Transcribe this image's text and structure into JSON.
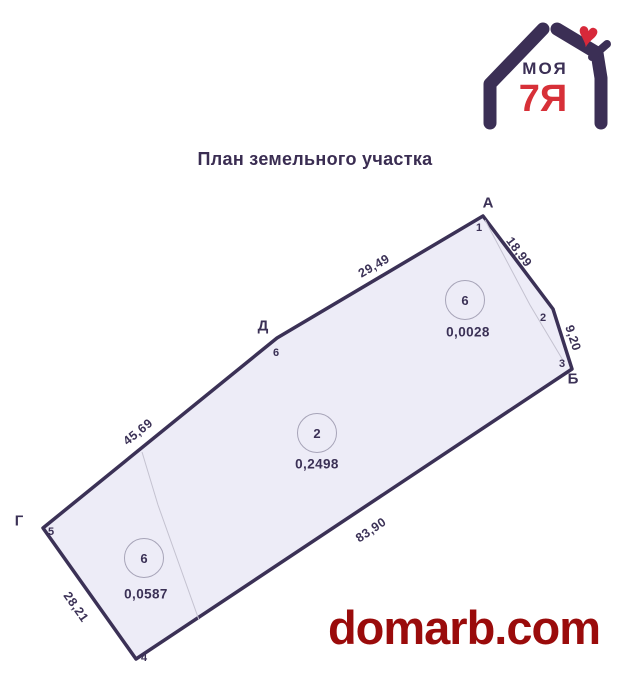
{
  "logo": {
    "brand_line1": "МОЯ",
    "brand_line2": "7Я",
    "heart_icon": "♥"
  },
  "title": "План земельного участка",
  "watermark": "domarb.com",
  "colors": {
    "outline_navy": "#3b3156",
    "parcel_fill": "#edecf7",
    "divider_gray": "#c4c2d0",
    "logo_navy": "#3b2f55",
    "logo_red": "#d73038",
    "watermark_red": "#9a0b0b"
  },
  "plan": {
    "vertices": [
      "А",
      "Б",
      "Г",
      "Д"
    ],
    "points": [
      "1",
      "2",
      "3",
      "4",
      "5",
      "6"
    ],
    "edges": [
      "29,49",
      "18,99",
      "9,20",
      "45,69",
      "28,21",
      "83,90"
    ],
    "parcels": [
      {
        "number": "6",
        "area": "0,0028"
      },
      {
        "number": "2",
        "area": "0,2498"
      },
      {
        "number": "6",
        "area": "0,0587"
      }
    ]
  }
}
